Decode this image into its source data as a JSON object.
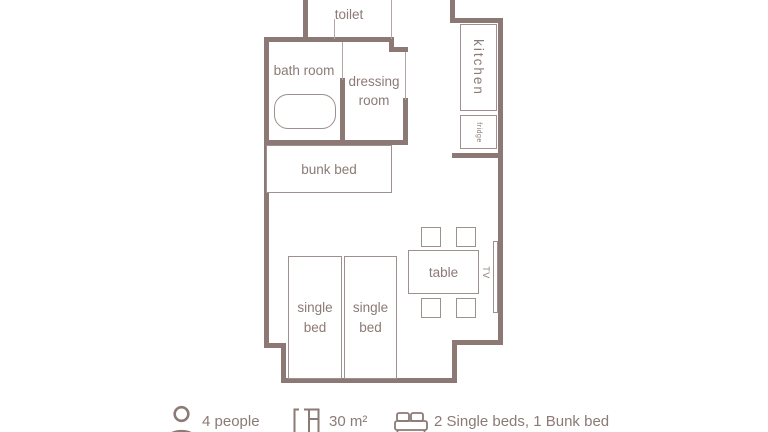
{
  "rooms": {
    "toilet": "toilet",
    "bath_room": "bath room",
    "dressing_room": "dressing room",
    "kitchen": "kitchen",
    "fridge": "fridge"
  },
  "furniture": {
    "bunk_bed": "bunk bed",
    "table": "table",
    "tv": "TV",
    "single_bed_left": "single bed",
    "single_bed_right": "single bed"
  },
  "legend": {
    "people": {
      "icon": "person-icon",
      "label": "4 people"
    },
    "area": {
      "icon": "floorplan-icon",
      "label": "30 m²"
    },
    "beds": {
      "icon": "bed-icon",
      "label": "2 Single beds, 1 Bunk bed"
    }
  },
  "colors": {
    "wall": "#8c7875",
    "furniture_line": "#9e908c",
    "door_line": "#b3a6a3",
    "text": "#8b7a75",
    "background": "#ffffff"
  }
}
